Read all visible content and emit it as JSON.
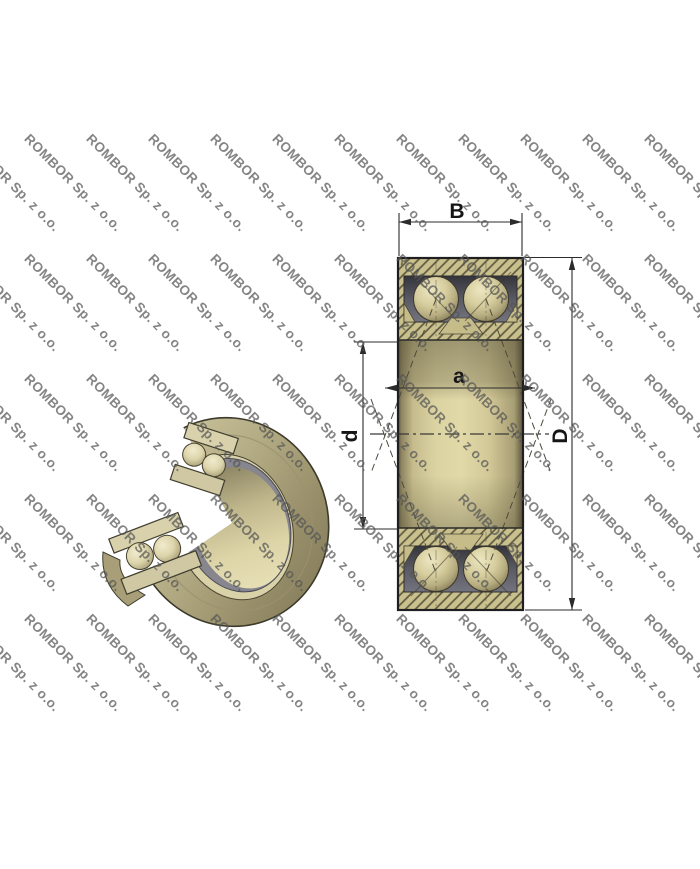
{
  "watermark": {
    "text": "ROMBOR Sp. z o.o.",
    "color": "#8a8a8a",
    "angle_deg": 45
  },
  "drawing": {
    "description_labels": {
      "B": "B",
      "a": "a",
      "d": "d",
      "D": "D"
    }
  },
  "colors": {
    "background": "#ffffff",
    "ring_khaki": "#c9c08d",
    "hatch_line": "#5e5a40",
    "cage_gray": "#70707b",
    "ball_light": "#e8e2bd",
    "bore_cream": "#e0d7a8",
    "outline_dark": "#1f1f1f",
    "dimension_ink": "#2b2b2b",
    "watermark_gray": "#8a8a8a"
  }
}
